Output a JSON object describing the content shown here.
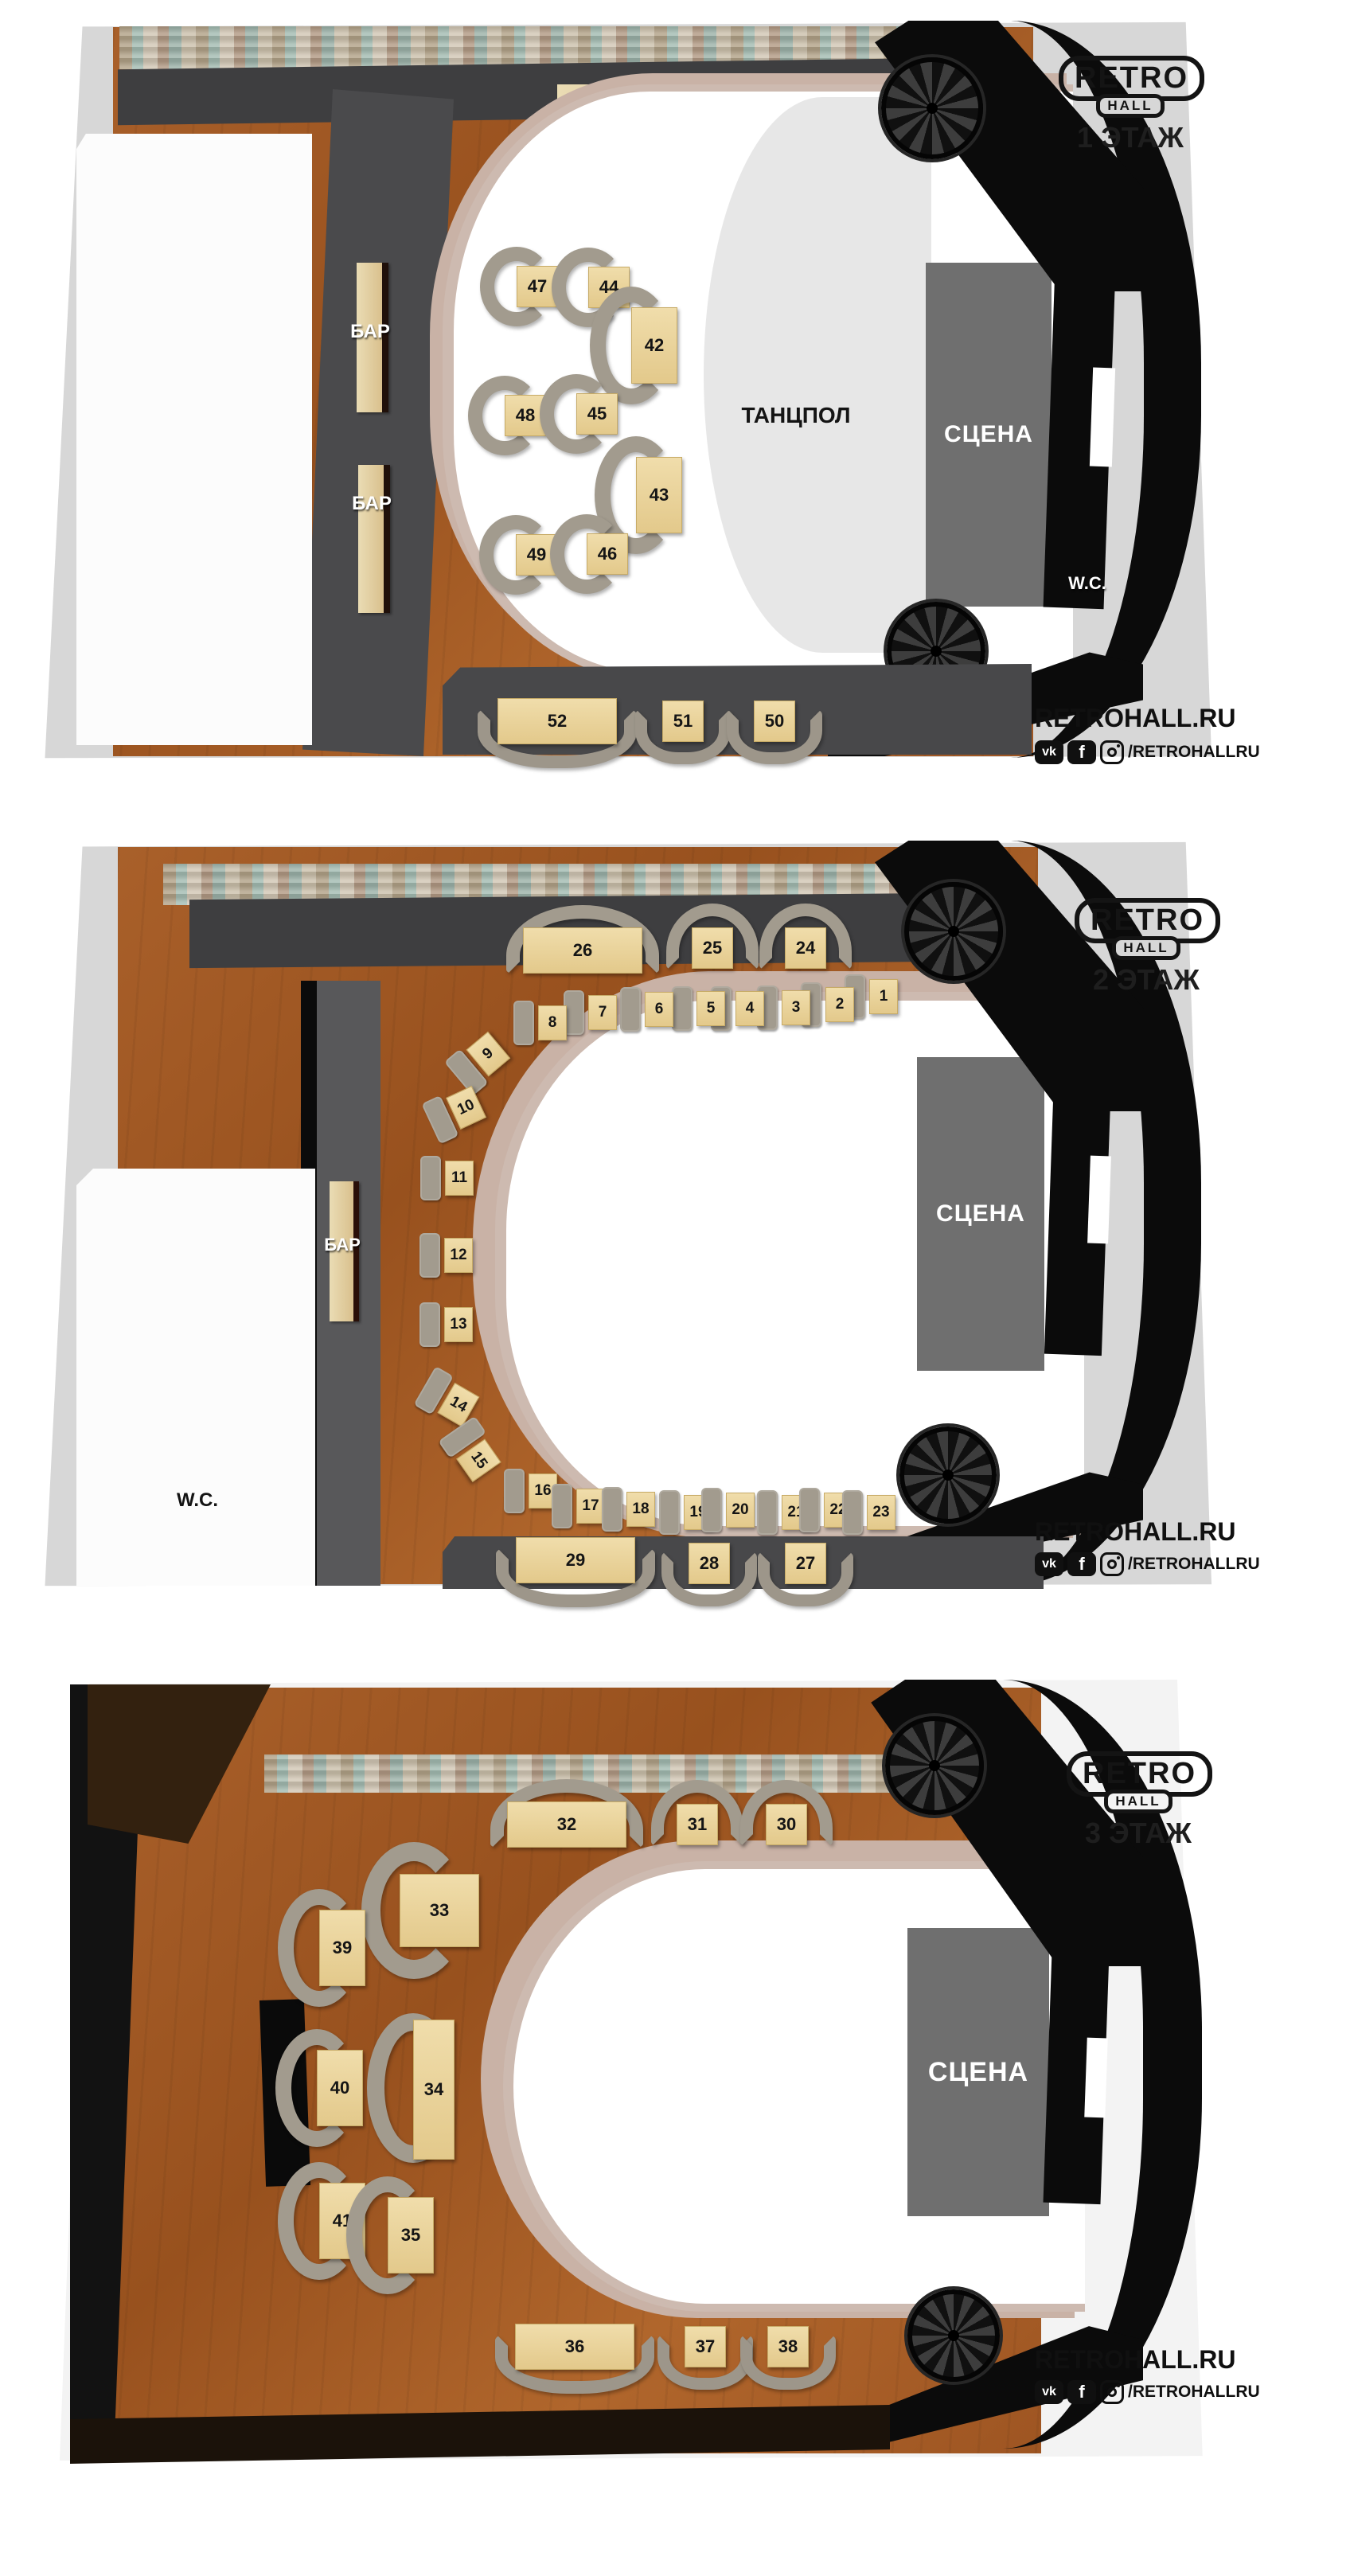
{
  "brand": {
    "logo_top": "RETRO",
    "logo_bottom": "HALL",
    "site": "RETROHALL.RU",
    "social_handle": "/RETROHALLRU",
    "vk_label": "vk",
    "fb_label": "f"
  },
  "colors": {
    "backdrop": "#d7d7d7",
    "wood_floor": "#a05a24",
    "carpet": "#434345",
    "wall_black": "#0b0b0b",
    "table_tan": "#ead398",
    "sofa_grey": "#a29b8e",
    "stage_grey": "#6f6f6f",
    "dance_grey": "#e7e7e7",
    "rail": "#cdbab0"
  },
  "floors": [
    {
      "title": "1 ЭТАЖ",
      "labels": {
        "stage": "СЦЕНА",
        "dancefloor": "ТАНЦПОЛ",
        "wc": "W.C.",
        "bar_top": "БАР",
        "bar_left_upper": "БАР",
        "bar_left_lower": "БАР"
      },
      "tables": [
        "47",
        "44",
        "42",
        "48",
        "45",
        "43",
        "49",
        "46",
        "52",
        "51",
        "50"
      ]
    },
    {
      "title": "2 ЭТАЖ",
      "labels": {
        "stage": "СЦЕНА",
        "wc": "W.C.",
        "bar": "БАР"
      },
      "tables": [
        "26",
        "25",
        "24",
        "1",
        "2",
        "3",
        "4",
        "5",
        "6",
        "7",
        "8",
        "9",
        "10",
        "11",
        "12",
        "13",
        "14",
        "15",
        "16",
        "17",
        "18",
        "19",
        "20",
        "21",
        "22",
        "23",
        "29",
        "28",
        "27"
      ]
    },
    {
      "title": "3 ЭТАЖ",
      "labels": {
        "stage": "СЦЕНА"
      },
      "tables": [
        "32",
        "31",
        "30",
        "33",
        "39",
        "40",
        "34",
        "41",
        "35",
        "36",
        "37",
        "38"
      ]
    }
  ]
}
